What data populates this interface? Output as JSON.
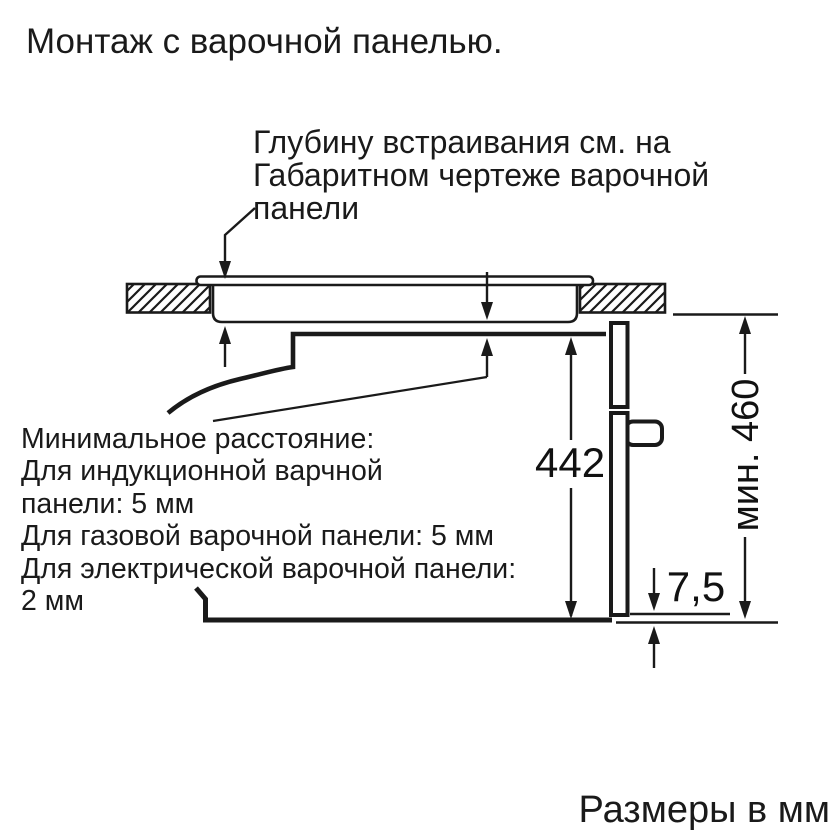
{
  "title": "Монтаж с варочной панелью.",
  "annotation": {
    "lines": [
      "Глубину встраивания см. на",
      "Габаритном чертеже варочной",
      "панели"
    ]
  },
  "min_distance_note": {
    "lines": [
      "Минимальное расстояние:",
      "Для индукционной варчной",
      "панели: 5 мм",
      "Для газовой варочной панели: 5 мм",
      "Для электрической варочной панели:",
      "2 мм"
    ]
  },
  "dimensions": {
    "oven_height": "442",
    "bottom_gap": "7,5",
    "niche_height": "мин. 460"
  },
  "units_note": "Размеры в мм",
  "colors": {
    "line": "#1a1a1a",
    "background": "#ffffff"
  }
}
